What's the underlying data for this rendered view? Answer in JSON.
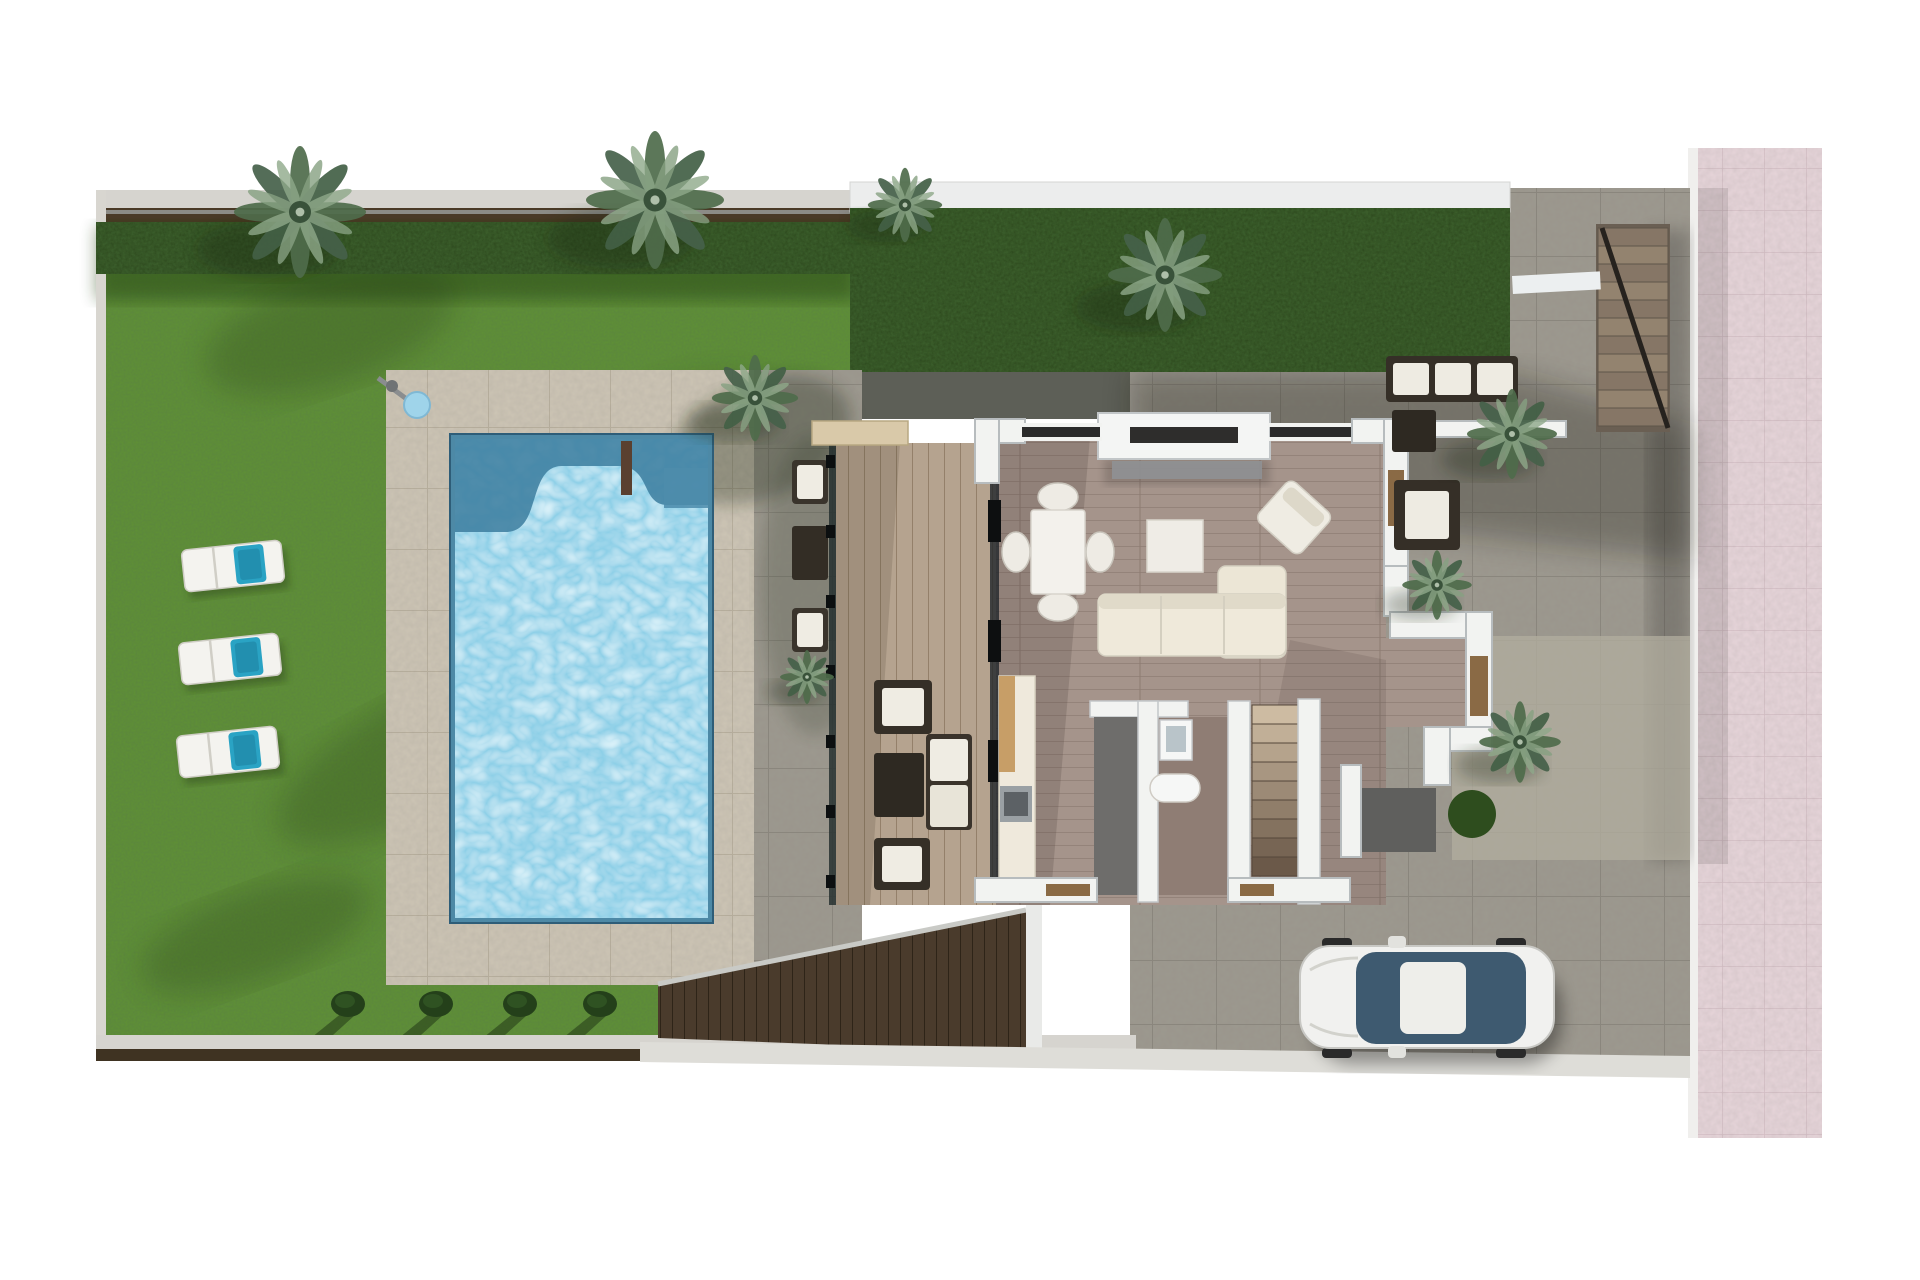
{
  "scene": {
    "inventory": [
      "garden-lawn",
      "swimming-pool",
      "pool-shower",
      "sun-loungers",
      "palm-trees",
      "pool-terrace",
      "wood-deck",
      "living-room",
      "dining-set",
      "sofa",
      "tv-unit",
      "kitchen",
      "bathroom",
      "interior-staircase",
      "exterior-staircase",
      "entrance-court",
      "patio",
      "driveway",
      "car",
      "pink-sidewalk",
      "garden-fence",
      "hedge"
    ],
    "palette": {
      "bg": "#ffffff",
      "lawn": "#5f9134",
      "lawn_dark": "#3c641e",
      "hedge": "#2c481c",
      "terrace": "#cdc5b5",
      "terrace_grout": "#b9b09e",
      "patio": "#9d998f",
      "patio_grout": "#8a867c",
      "sidewalk_pink": "#e7d5da",
      "sidewalk_grout": "#d5bfc6",
      "water": "#8ccfe7",
      "water_deep": "#3f7fa0",
      "water_steps": "#4e8cab",
      "deck_wood": "#b5a38f",
      "floor_wood": "#a5948b",
      "floor_bath": "#8f7d74",
      "wall": "#f2f3f1",
      "wall_edge": "#b7bcbe",
      "wall_dark": "#6e6d6b",
      "furniture_cream": "#efece3",
      "furniture_dark": "#352f27",
      "door_wood": "#8a6a45",
      "travertine": "#d9c9a9",
      "fence_brown": "#4a3a27",
      "path_gray": "#d6d4cf",
      "car_glass": "#3e5a70",
      "car_body": "#f1f1ef",
      "towel_blue": "#2aa3c4",
      "step_light": "#cdbba2",
      "step_dark": "#6b5949",
      "slats_brown": "#4a3b2c",
      "mat_gray": "#5f5f5d",
      "street_band": "#deddd8"
    },
    "garden": {
      "loungers": [
        {
          "x": 183,
          "y": 545,
          "rot": -6
        },
        {
          "x": 180,
          "y": 638,
          "rot": -6
        },
        {
          "x": 178,
          "y": 731,
          "rot": -6
        }
      ],
      "bushes": [
        {
          "x": 348,
          "y": 1004
        },
        {
          "x": 436,
          "y": 1004
        },
        {
          "x": 520,
          "y": 1004
        },
        {
          "x": 600,
          "y": 1004
        }
      ],
      "shadows": [
        {
          "x": 330,
          "y": 330,
          "rx": 130,
          "ry": 55,
          "rot": -18
        },
        {
          "x": 600,
          "y": 500,
          "rx": 200,
          "ry": 75,
          "rot": -32
        },
        {
          "x": 430,
          "y": 750,
          "rx": 170,
          "ry": 60,
          "rot": -28
        },
        {
          "x": 255,
          "y": 935,
          "rx": 120,
          "ry": 45,
          "rot": -20
        }
      ]
    },
    "palms": [
      {
        "x": 300,
        "y": 212,
        "s": 1.1
      },
      {
        "x": 655,
        "y": 200,
        "s": 1.15
      },
      {
        "x": 905,
        "y": 205,
        "s": 0.62
      },
      {
        "x": 1165,
        "y": 275,
        "s": 0.95
      },
      {
        "x": 755,
        "y": 398,
        "s": 0.72
      },
      {
        "x": 807,
        "y": 677,
        "s": 0.45
      },
      {
        "x": 1437,
        "y": 585,
        "s": 0.58
      },
      {
        "x": 1512,
        "y": 434,
        "s": 0.75
      },
      {
        "x": 1520,
        "y": 742,
        "s": 0.68
      }
    ],
    "balustrade_posts": [
      455,
      525,
      595,
      665,
      735,
      805,
      875
    ],
    "stairs": {
      "exterior": {
        "x": 1598,
        "y": 228,
        "w": 70,
        "step_h": 18,
        "count": 11
      },
      "interior": {
        "x": 1252,
        "y": 705,
        "w": 46,
        "step_h": 19,
        "count": 9
      }
    }
  }
}
